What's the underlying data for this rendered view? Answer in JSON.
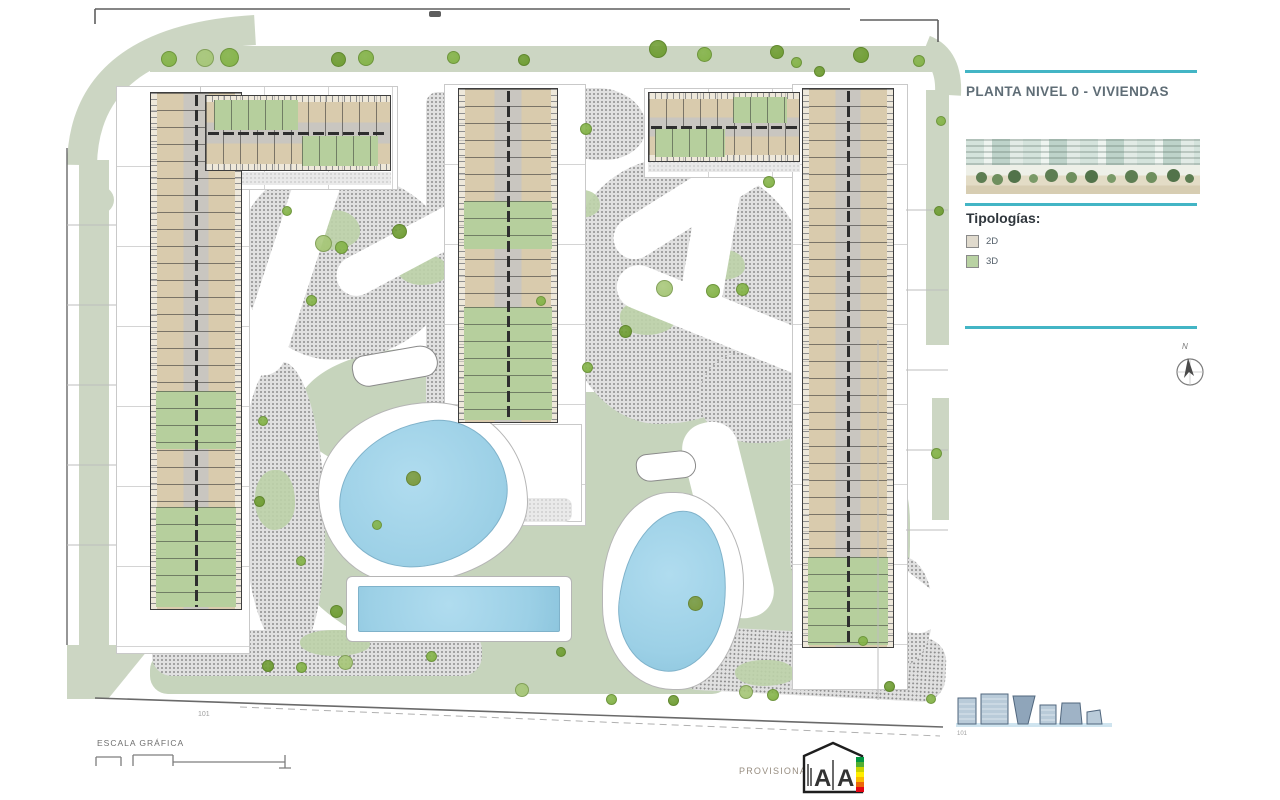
{
  "sidebar": {
    "title": "PLANTA NIVEL 0 - VIVIENDAS",
    "typologies_heading": "Tipologías:",
    "legend": [
      {
        "label": "2D",
        "swatch": "#e0dacd"
      },
      {
        "label": "3D",
        "swatch": "#b9d2a3"
      }
    ],
    "accent_color": "#43b5c5",
    "compass_label": "N",
    "elevations_caption": "101"
  },
  "plan": {
    "area_caption": "101",
    "colors": {
      "lawn": "#c6d4bc",
      "road_band": "#ccd6c3",
      "stipple_gray": "#8d8d8d",
      "pool_water": "#9cd0e6",
      "unit_2d": "#d9cbad",
      "unit_3d": "#b6cf9d",
      "outline": "#3e3e3e"
    },
    "trees": [
      [
        168,
        58,
        14,
        "g"
      ],
      [
        204,
        57,
        16,
        "l"
      ],
      [
        228,
        56,
        17,
        "g"
      ],
      [
        337,
        58,
        13,
        "o"
      ],
      [
        365,
        57,
        14,
        "g"
      ],
      [
        452,
        56,
        11,
        "g"
      ],
      [
        523,
        59,
        10,
        "o"
      ],
      [
        657,
        48,
        16,
        "o"
      ],
      [
        703,
        53,
        13,
        "g"
      ],
      [
        776,
        51,
        12,
        "o"
      ],
      [
        795,
        61,
        9,
        "g"
      ],
      [
        860,
        54,
        14,
        "o"
      ],
      [
        918,
        60,
        10,
        "g"
      ],
      [
        322,
        242,
        15,
        "l"
      ],
      [
        340,
        246,
        11,
        "g"
      ],
      [
        398,
        230,
        13,
        "o"
      ],
      [
        310,
        299,
        9,
        "g"
      ],
      [
        286,
        210,
        8,
        "g"
      ],
      [
        262,
        420,
        8,
        "g"
      ],
      [
        258,
        500,
        9,
        "o"
      ],
      [
        300,
        560,
        8,
        "g"
      ],
      [
        585,
        128,
        10,
        "g"
      ],
      [
        663,
        287,
        15,
        "l"
      ],
      [
        712,
        290,
        12,
        "g"
      ],
      [
        624,
        330,
        11,
        "o"
      ],
      [
        586,
        366,
        9,
        "g"
      ],
      [
        540,
        300,
        8,
        "g"
      ],
      [
        741,
        288,
        11,
        "g"
      ],
      [
        768,
        181,
        10,
        "g"
      ],
      [
        818,
        70,
        9,
        "o"
      ],
      [
        412,
        477,
        13,
        "p"
      ],
      [
        694,
        602,
        13,
        "p"
      ],
      [
        376,
        524,
        8,
        "g"
      ],
      [
        335,
        610,
        11,
        "o"
      ],
      [
        344,
        661,
        13,
        "l"
      ],
      [
        300,
        666,
        9,
        "g"
      ],
      [
        267,
        665,
        10,
        "o"
      ],
      [
        430,
        655,
        9,
        "g"
      ],
      [
        521,
        689,
        12,
        "l"
      ],
      [
        560,
        651,
        8,
        "o"
      ],
      [
        610,
        698,
        9,
        "g"
      ],
      [
        672,
        699,
        9,
        "o"
      ],
      [
        745,
        691,
        12,
        "l"
      ],
      [
        772,
        694,
        10,
        "g"
      ],
      [
        888,
        685,
        9,
        "o"
      ],
      [
        862,
        640,
        8,
        "g"
      ],
      [
        935,
        452,
        9,
        "g"
      ],
      [
        930,
        698,
        8,
        "g"
      ],
      [
        940,
        120,
        8,
        "g"
      ],
      [
        938,
        210,
        8,
        "o"
      ]
    ]
  },
  "footer": {
    "scale_label": "ESCALA GRÁFICA",
    "provisional_label": "PROVISIONAL",
    "energy_letters": [
      "A",
      "A"
    ]
  }
}
